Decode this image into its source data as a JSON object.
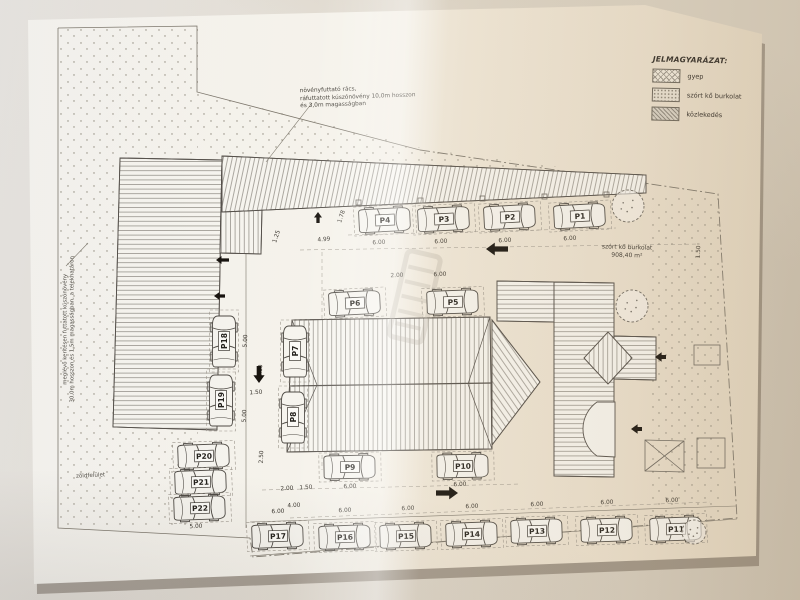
{
  "colors": {
    "background": "#d8d1c5",
    "paper": "#f6f4ee",
    "ink": "#4e4a44",
    "boundary": "#7d776c",
    "arrow": "#17130e",
    "dim_text": "#3a362f"
  },
  "legend": {
    "title": "JELMAGYARÁZAT:",
    "items": [
      {
        "label": "gyep",
        "pattern": "crosshatch"
      },
      {
        "label": "szórt kő burkolat",
        "pattern": "stipple"
      },
      {
        "label": "közlekedés",
        "pattern": "dense-hatch"
      }
    ]
  },
  "annotations": {
    "top_lines": [
      "növényfuttató rács,",
      "ráfuttatott kúszónövény 10,0m hosszon",
      "és 3,0m magasságban"
    ],
    "left_lines": [
      "meglévő kerítésen futtatott kúszónövény",
      "30,0m hosszon és 1,5m magasságban, a telekhatáron"
    ],
    "area_label_lines": [
      "szórt kő burkolat",
      "908,40 m²"
    ],
    "green_label": "zöldfelület"
  },
  "plan": {
    "parking_spots": [
      {
        "label": "P1",
        "x": 580,
        "y": 216,
        "a": -3
      },
      {
        "label": "P2",
        "x": 510,
        "y": 217,
        "a": -3
      },
      {
        "label": "P3",
        "x": 444,
        "y": 219,
        "a": -3
      },
      {
        "label": "P4",
        "x": 385,
        "y": 220,
        "a": -3
      },
      {
        "label": "P5",
        "x": 453,
        "y": 302,
        "a": -2
      },
      {
        "label": "P6",
        "x": 355,
        "y": 303,
        "a": -3
      },
      {
        "label": "P7",
        "x": 295,
        "y": 351,
        "a": -90
      },
      {
        "label": "P8",
        "x": 293,
        "y": 417,
        "a": -90
      },
      {
        "label": "P9",
        "x": 350,
        "y": 467,
        "a": -1
      },
      {
        "label": "P10",
        "x": 463,
        "y": 466,
        "a": -1
      },
      {
        "label": "P11",
        "x": 676,
        "y": 529,
        "a": -2
      },
      {
        "label": "P12",
        "x": 607,
        "y": 530,
        "a": -2
      },
      {
        "label": "P13",
        "x": 537,
        "y": 531,
        "a": -2
      },
      {
        "label": "P14",
        "x": 472,
        "y": 534,
        "a": -2
      },
      {
        "label": "P15",
        "x": 406,
        "y": 536,
        "a": -2
      },
      {
        "label": "P16",
        "x": 345,
        "y": 537,
        "a": -2
      },
      {
        "label": "P17",
        "x": 278,
        "y": 536,
        "a": -2
      },
      {
        "label": "P18",
        "x": 224,
        "y": 341,
        "a": -90
      },
      {
        "label": "P19",
        "x": 221,
        "y": 400,
        "a": -90
      },
      {
        "label": "P20",
        "x": 204,
        "y": 456,
        "a": -2
      },
      {
        "label": "P21",
        "x": 201,
        "y": 482,
        "a": -2
      },
      {
        "label": "P22",
        "x": 200,
        "y": 508,
        "a": -2
      }
    ],
    "dimension_labels": [
      {
        "t": "1.25",
        "x": 278,
        "y": 237,
        "r": -72
      },
      {
        "t": "4.99",
        "x": 324,
        "y": 241,
        "r": -4
      },
      {
        "t": "1.78",
        "x": 343,
        "y": 217,
        "r": -72
      },
      {
        "t": "6.00",
        "x": 379,
        "y": 244,
        "r": -3
      },
      {
        "t": "6.00",
        "x": 441,
        "y": 243,
        "r": -3
      },
      {
        "t": "6.00",
        "x": 505,
        "y": 242,
        "r": -3
      },
      {
        "t": "6.00",
        "x": 570,
        "y": 240,
        "r": -3
      },
      {
        "t": "1.50",
        "x": 700,
        "y": 252,
        "r": -88
      },
      {
        "t": "2.00",
        "x": 397,
        "y": 277,
        "r": -2
      },
      {
        "t": "6.00",
        "x": 440,
        "y": 276,
        "r": -2
      },
      {
        "t": "5.00",
        "x": 247,
        "y": 341,
        "r": -88
      },
      {
        "t": "6.00",
        "x": 262,
        "y": 371,
        "r": -88
      },
      {
        "t": "1.50",
        "x": 256,
        "y": 394,
        "r": -3
      },
      {
        "t": "5.00",
        "x": 246,
        "y": 416,
        "r": -88
      },
      {
        "t": "2.50",
        "x": 263,
        "y": 457,
        "r": -88
      },
      {
        "t": "2.00",
        "x": 287,
        "y": 490,
        "r": -3
      },
      {
        "t": "1.50",
        "x": 306,
        "y": 489,
        "r": -3
      },
      {
        "t": "4.00",
        "x": 294,
        "y": 507,
        "r": -3
      },
      {
        "t": "5.00",
        "x": 196,
        "y": 528,
        "r": -2
      },
      {
        "t": "6.00",
        "x": 350,
        "y": 488,
        "r": -2
      },
      {
        "t": "6.00",
        "x": 460,
        "y": 486,
        "r": -2
      },
      {
        "t": "6.00",
        "x": 278,
        "y": 513,
        "r": -2
      },
      {
        "t": "6.00",
        "x": 345,
        "y": 512,
        "r": -2
      },
      {
        "t": "6.00",
        "x": 408,
        "y": 510,
        "r": -2
      },
      {
        "t": "6.00",
        "x": 472,
        "y": 508,
        "r": -2
      },
      {
        "t": "6.00",
        "x": 537,
        "y": 506,
        "r": -2
      },
      {
        "t": "6.00",
        "x": 607,
        "y": 504,
        "r": -2
      },
      {
        "t": "6.00",
        "x": 672,
        "y": 502,
        "r": -2
      }
    ],
    "arrows": [
      {
        "d": "left",
        "x": 486,
        "y": 249,
        "l": 22,
        "t": 8
      },
      {
        "d": "right",
        "x": 458,
        "y": 493,
        "l": 22,
        "t": 8
      },
      {
        "d": "down",
        "x": 259,
        "y": 383,
        "l": 17,
        "t": 7
      },
      {
        "d": "up",
        "x": 318,
        "y": 212,
        "l": 11,
        "t": 5
      },
      {
        "d": "left",
        "x": 216,
        "y": 260,
        "l": 13,
        "t": 5
      },
      {
        "d": "left",
        "x": 214,
        "y": 296,
        "l": 11,
        "t": 5
      },
      {
        "d": "left",
        "x": 655,
        "y": 357,
        "l": 11,
        "t": 6
      },
      {
        "d": "left",
        "x": 631,
        "y": 429,
        "l": 11,
        "t": 6
      }
    ],
    "trees": [
      {
        "x": 628,
        "y": 206,
        "r": 16
      },
      {
        "x": 632,
        "y": 306,
        "r": 16
      },
      {
        "x": 694,
        "y": 532,
        "r": 12
      }
    ]
  }
}
